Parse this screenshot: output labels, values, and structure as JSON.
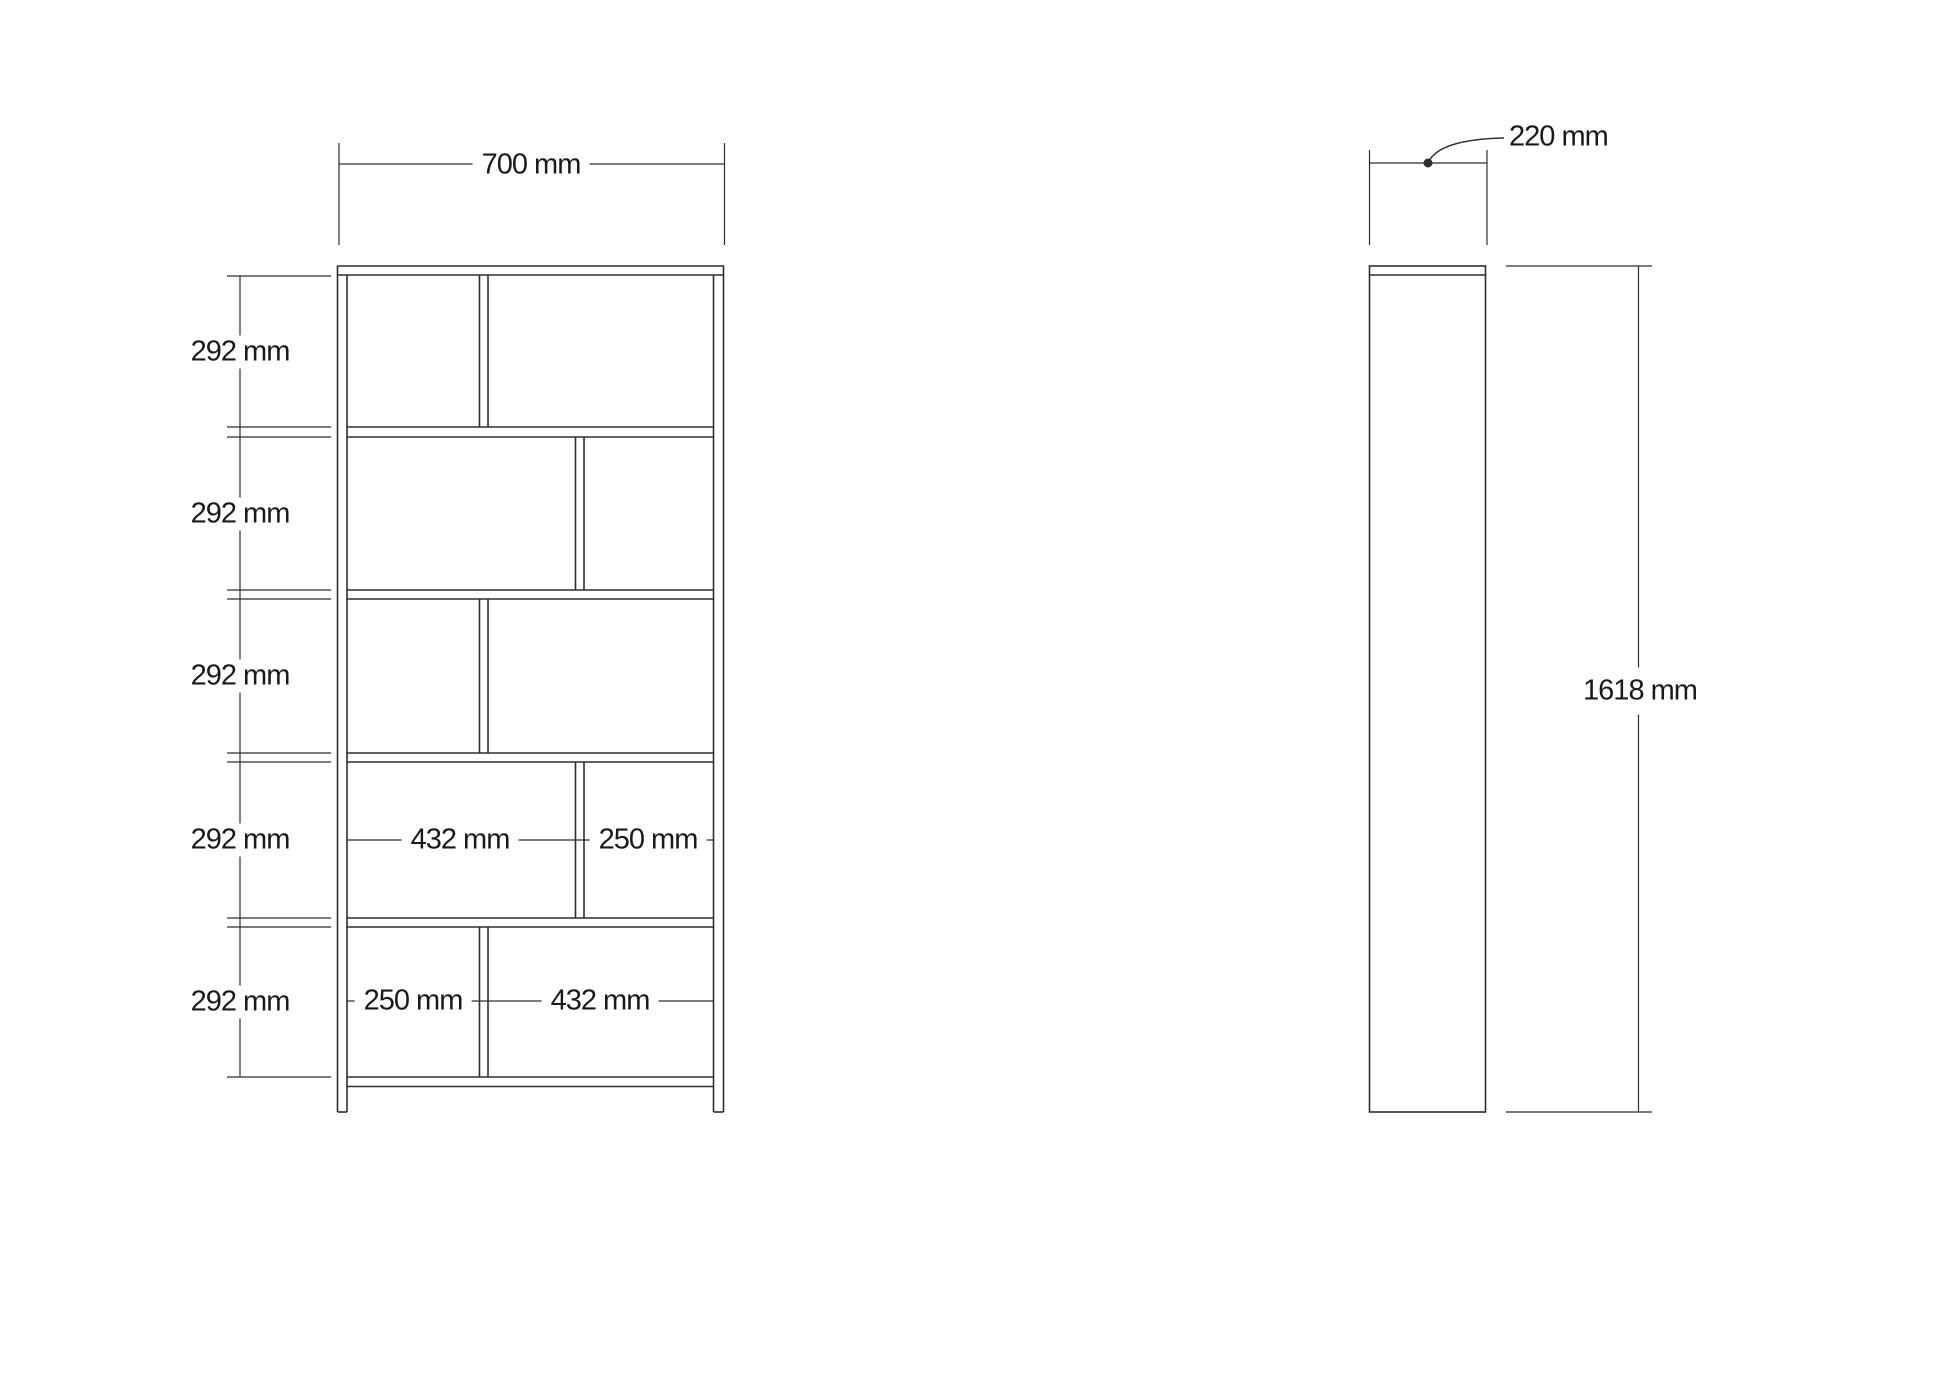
{
  "front": {
    "width_label": "700 mm",
    "row_labels": [
      "292 mm",
      "292 mm",
      "292 mm",
      "292 mm",
      "292 mm"
    ],
    "row4_left": "432 mm",
    "row4_right": "250 mm",
    "row5_left": "250 mm",
    "row5_right": "432 mm"
  },
  "side": {
    "depth_label": "220 mm",
    "height_label": "1618 mm"
  },
  "colors": {
    "line": "#2e2e2e",
    "text": "#1a1a1a",
    "background": "#ffffff"
  }
}
